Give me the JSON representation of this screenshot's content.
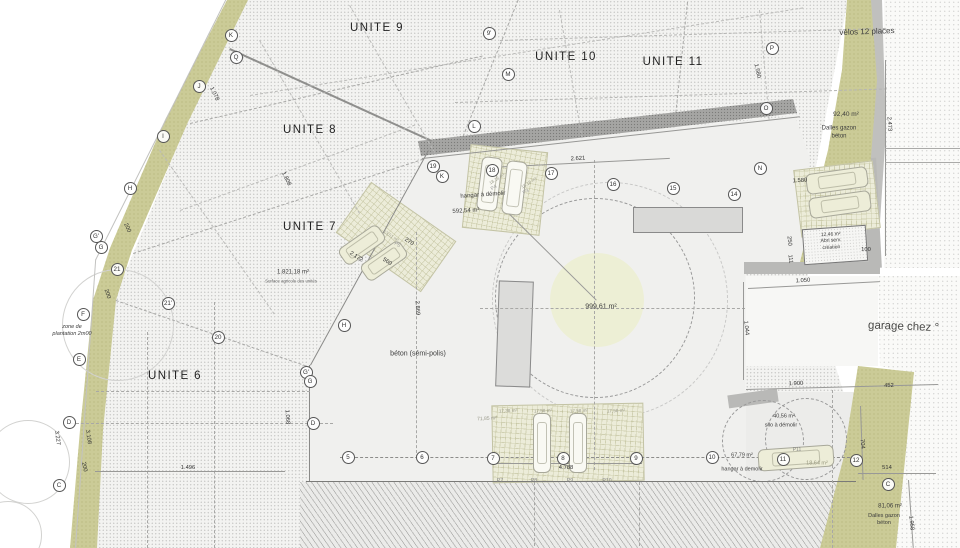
{
  "colors": {
    "paper": "#ffffff",
    "parcel_hatch": "#f3f3f1",
    "planting_strip": "#cbcb97",
    "parking_lot": "#ececd9",
    "boundary_band": "#a5a5a3",
    "building": "#dcdcda",
    "center_zone": "#edefd5",
    "text": "#3c3c3c"
  },
  "units": [
    {
      "label": "UNITE 9",
      "x": 377,
      "y": 28
    },
    {
      "label": "UNITE 10",
      "x": 566,
      "y": 57
    },
    {
      "label": "UNITE 11",
      "x": 673,
      "y": 62
    },
    {
      "label": "UNITE 8",
      "x": 310,
      "y": 130
    },
    {
      "label": "UNITE 7",
      "x": 310,
      "y": 227
    },
    {
      "label": "UNITE 6",
      "x": 175,
      "y": 376
    }
  ],
  "letter_markers": [
    {
      "label": "K",
      "x": 231,
      "y": 35
    },
    {
      "label": "Q",
      "x": 236,
      "y": 57
    },
    {
      "label": "J",
      "x": 199,
      "y": 86
    },
    {
      "label": "I",
      "x": 163,
      "y": 136
    },
    {
      "label": "H",
      "x": 130,
      "y": 188
    },
    {
      "label": "G'",
      "x": 96,
      "y": 236
    },
    {
      "label": "G",
      "x": 101,
      "y": 247
    },
    {
      "label": "F",
      "x": 83,
      "y": 314
    },
    {
      "label": "E",
      "x": 79,
      "y": 359
    },
    {
      "label": "D",
      "x": 69,
      "y": 422
    },
    {
      "label": "C",
      "x": 59,
      "y": 485
    },
    {
      "label": "H",
      "x": 344,
      "y": 325
    },
    {
      "label": "G'",
      "x": 306,
      "y": 372
    },
    {
      "label": "G",
      "x": 310,
      "y": 381
    },
    {
      "label": "D",
      "x": 313,
      "y": 423
    },
    {
      "label": "9'",
      "x": 489,
      "y": 33
    },
    {
      "label": "M",
      "x": 508,
      "y": 74
    },
    {
      "label": "L",
      "x": 474,
      "y": 126
    },
    {
      "label": "K",
      "x": 442,
      "y": 176
    },
    {
      "label": "P",
      "x": 772,
      "y": 48
    },
    {
      "label": "O",
      "x": 766,
      "y": 108
    },
    {
      "label": "N",
      "x": 760,
      "y": 168
    },
    {
      "label": "C",
      "x": 888,
      "y": 484
    }
  ],
  "number_markers": [
    {
      "label": "21",
      "x": 117,
      "y": 269
    },
    {
      "label": "21'",
      "x": 168,
      "y": 303
    },
    {
      "label": "20",
      "x": 218,
      "y": 337
    },
    {
      "label": "19",
      "x": 433,
      "y": 166
    },
    {
      "label": "18",
      "x": 492,
      "y": 170
    },
    {
      "label": "17",
      "x": 551,
      "y": 173
    },
    {
      "label": "16",
      "x": 613,
      "y": 184
    },
    {
      "label": "15",
      "x": 673,
      "y": 188
    },
    {
      "label": "14",
      "x": 734,
      "y": 194
    },
    {
      "label": "5",
      "x": 348,
      "y": 457
    },
    {
      "label": "6",
      "x": 422,
      "y": 457
    },
    {
      "label": "7",
      "x": 493,
      "y": 458
    },
    {
      "label": "8",
      "x": 563,
      "y": 458
    },
    {
      "label": "9",
      "x": 636,
      "y": 458
    },
    {
      "label": "10",
      "x": 712,
      "y": 457
    },
    {
      "label": "11",
      "x": 783,
      "y": 459
    },
    {
      "label": "12",
      "x": 856,
      "y": 460
    }
  ],
  "annotations": [
    {
      "text": "vélos 12 places",
      "x": 867,
      "y": 32,
      "fs": 8,
      "rot": -2
    },
    {
      "text": "92,40 m²",
      "x": 846,
      "y": 115,
      "fs": 6.5
    },
    {
      "text": "Dalles gazon\nbéton",
      "x": 839,
      "y": 133,
      "fs": 6
    },
    {
      "text": "hangar à démolir",
      "x": 483,
      "y": 196,
      "fs": 6,
      "rot": -4
    },
    {
      "text": "592,54 m²",
      "x": 466,
      "y": 212,
      "fs": 6,
      "rot": -3
    },
    {
      "text": "1.821,18 m²",
      "x": 293,
      "y": 273,
      "fs": 6
    },
    {
      "text": "Surface agricole des unités",
      "x": 291,
      "y": 281,
      "fs": 4.3,
      "color": "#666"
    },
    {
      "text": "zone de\nplantation 2m00",
      "x": 72,
      "y": 331,
      "fs": 5.5,
      "italic": true
    },
    {
      "text": "béton (sémi-polis)",
      "x": 418,
      "y": 355,
      "fs": 7
    },
    {
      "text": "999,61 m²",
      "x": 601,
      "y": 308,
      "fs": 7
    },
    {
      "text": "garage chez °",
      "x": 868,
      "y": 327,
      "fs": 11.5,
      "rot": 2,
      "color": "#4a4a48",
      "anchor": "left"
    },
    {
      "text": "12,46 m²\nAbri serv.\ncréation",
      "x": 831,
      "y": 241,
      "fs": 5,
      "rot": -3
    },
    {
      "text": "40,56 m²",
      "x": 784,
      "y": 417,
      "fs": 5.5
    },
    {
      "text": "silo à démolir",
      "x": 781,
      "y": 426,
      "fs": 5.5
    },
    {
      "text": "67,79 m²",
      "x": 742,
      "y": 456,
      "fs": 5.5
    },
    {
      "text": "hangar à demolir",
      "x": 742,
      "y": 470,
      "fs": 5.5
    },
    {
      "text": "18,64 m²",
      "x": 817,
      "y": 464,
      "fs": 5.5,
      "color": "#99997f"
    },
    {
      "text": "P11",
      "x": 797,
      "y": 450,
      "fs": 5,
      "color": "#888"
    },
    {
      "text": "81,06 m²",
      "x": 890,
      "y": 507,
      "fs": 6
    },
    {
      "text": "Dalles gazon\nbéton",
      "x": 884,
      "y": 520,
      "fs": 5.5
    },
    {
      "text": "71,85 m²",
      "x": 487,
      "y": 419,
      "fs": 5,
      "rot": -3,
      "color": "#99998a"
    },
    {
      "text": "17,38 m²",
      "x": 508,
      "y": 411,
      "fs": 4.6,
      "rot": -3,
      "color": "#99998a"
    },
    {
      "text": "17,58 m²",
      "x": 543,
      "y": 411,
      "fs": 4.6,
      "rot": -3,
      "color": "#99998a"
    },
    {
      "text": "17,58 m²",
      "x": 579,
      "y": 411,
      "fs": 4.6,
      "rot": -3,
      "color": "#99998a"
    },
    {
      "text": "17,58 m²",
      "x": 616,
      "y": 411,
      "fs": 4.6,
      "rot": -3,
      "color": "#99998a"
    },
    {
      "text": "P7",
      "x": 500,
      "y": 481,
      "fs": 5.2,
      "color": "#888"
    },
    {
      "text": "P8",
      "x": 534,
      "y": 481,
      "fs": 5.2,
      "color": "#888"
    },
    {
      "text": "P9",
      "x": 570,
      "y": 481,
      "fs": 5.2,
      "color": "#888"
    },
    {
      "text": "P10",
      "x": 607,
      "y": 481,
      "fs": 5.2,
      "color": "#888"
    },
    {
      "text": "18,18 m²",
      "x": 497,
      "y": 179,
      "fs": 4.4,
      "rot": -32,
      "color": "#a0a090"
    },
    {
      "text": "P4",
      "x": 494,
      "y": 188,
      "fs": 5,
      "rot": -32,
      "color": "#999"
    },
    {
      "text": "18,18 m²",
      "x": 529,
      "y": 183,
      "fs": 4.4,
      "rot": -32,
      "color": "#a0a090"
    },
    {
      "text": "P3",
      "x": 526,
      "y": 192,
      "fs": 5,
      "rot": -32,
      "color": "#999"
    },
    {
      "text": "13,51 m²",
      "x": 391,
      "y": 236,
      "fs": 4.4,
      "rot": 33,
      "color": "#a0a090"
    },
    {
      "text": "P5",
      "x": 397,
      "y": 245,
      "fs": 5,
      "rot": 33,
      "color": "#999"
    }
  ],
  "dimensions": [
    {
      "text": "2.621",
      "x": 578,
      "y": 159,
      "rot": -3
    },
    {
      "text": "1.580",
      "x": 757,
      "y": 71,
      "rot": 78
    },
    {
      "text": "1.580",
      "x": 800,
      "y": 181,
      "rot": -3
    },
    {
      "text": "2.473",
      "x": 889,
      "y": 124,
      "rot": 86
    },
    {
      "text": "1.078",
      "x": 214,
      "y": 94,
      "rot": 64
    },
    {
      "text": "1.808",
      "x": 286,
      "y": 179,
      "rot": 64
    },
    {
      "text": "200",
      "x": 127,
      "y": 228,
      "rot": 64
    },
    {
      "text": "200",
      "x": 107,
      "y": 294,
      "rot": 72
    },
    {
      "text": "200",
      "x": 84,
      "y": 467,
      "rot": 78
    },
    {
      "text": "3.227",
      "x": 57,
      "y": 438,
      "rot": 82
    },
    {
      "text": "3.108",
      "x": 88,
      "y": 437,
      "rot": 82
    },
    {
      "text": "1.496",
      "x": 188,
      "y": 468,
      "rot": 0
    },
    {
      "text": "2.172",
      "x": 356,
      "y": 257,
      "rot": 33
    },
    {
      "text": "560",
      "x": 387,
      "y": 262,
      "rot": 33
    },
    {
      "text": "270",
      "x": 409,
      "y": 242,
      "rot": 33
    },
    {
      "text": "2.869",
      "x": 417,
      "y": 308,
      "rot": 87
    },
    {
      "text": "1.068",
      "x": 287,
      "y": 417,
      "rot": 87
    },
    {
      "text": "4.788",
      "x": 566,
      "y": 468,
      "rot": 0
    },
    {
      "text": "1.900",
      "x": 796,
      "y": 384,
      "rot": -2
    },
    {
      "text": "452",
      "x": 889,
      "y": 386,
      "rot": -2
    },
    {
      "text": "1.050",
      "x": 803,
      "y": 281,
      "rot": -3
    },
    {
      "text": "1.044",
      "x": 746,
      "y": 328,
      "rot": 84
    },
    {
      "text": "704",
      "x": 862,
      "y": 444,
      "rot": 84
    },
    {
      "text": "514",
      "x": 887,
      "y": 468,
      "rot": 0
    },
    {
      "text": "1.958",
      "x": 911,
      "y": 523,
      "rot": 84
    },
    {
      "text": "250",
      "x": 789,
      "y": 241,
      "rot": 84
    },
    {
      "text": "111",
      "x": 790,
      "y": 259,
      "rot": 84
    },
    {
      "text": "100",
      "x": 866,
      "y": 250,
      "rot": 0
    }
  ],
  "linework": [
    {
      "x": 230,
      "y": 48,
      "len": 222,
      "rot": 24.5,
      "style": "solid",
      "color": "#8f8f8d",
      "w": 2
    },
    {
      "x": 190,
      "y": 123,
      "len": 300,
      "rot": -13,
      "style": "dashed",
      "color": "#a8a8a6",
      "w": 1
    },
    {
      "x": 133,
      "y": 253,
      "len": 305,
      "rot": -18,
      "style": "dashed",
      "color": "#a8a8a6",
      "w": 1
    },
    {
      "x": 116,
      "y": 300,
      "len": 206,
      "rot": 19,
      "style": "dashed",
      "color": "#a8a8a6",
      "w": 1
    },
    {
      "x": 310,
      "y": 365,
      "len": 245,
      "rot": -61.2,
      "style": "solid",
      "color": "#8a8a88",
      "w": 1
    },
    {
      "x": 310,
      "y": 365,
      "len": 117,
      "rot": 90,
      "style": "solid",
      "color": "#8a8a88",
      "w": 1
    },
    {
      "x": 306,
      "y": 481,
      "len": 550,
      "rot": 0,
      "style": "solid",
      "color": "#7a7a78",
      "w": 1
    },
    {
      "x": 422,
      "y": 158,
      "len": 380,
      "rot": -6.3,
      "style": "solid",
      "color": "#979795",
      "w": 1
    },
    {
      "x": 457,
      "y": 150,
      "len": 162,
      "rot": -68,
      "style": "dashed",
      "color": "#a8a8a6",
      "w": 1
    },
    {
      "x": 688,
      "y": 2,
      "len": 126,
      "rot": 96,
      "style": "dashed",
      "color": "#a8a8a6",
      "w": 1
    },
    {
      "x": 500,
      "y": 40,
      "len": 386,
      "rot": -1.8,
      "style": "dashed",
      "color": "#b5b5b3",
      "w": 1
    },
    {
      "x": 455,
      "y": 102,
      "len": 432,
      "rot": -1.8,
      "style": "dashed",
      "color": "#b5b5b3",
      "w": 1
    },
    {
      "x": 250,
      "y": 95,
      "len": 560,
      "rot": -9,
      "style": "dashed",
      "color": "#bbbbb9",
      "w": 1
    },
    {
      "x": 180,
      "y": 210,
      "len": 250,
      "rot": -20,
      "style": "dashed",
      "color": "#bbbbb9",
      "w": 1
    },
    {
      "x": 350,
      "y": 5,
      "len": 170,
      "rot": 60,
      "style": "dashed",
      "color": "#bbbbb9",
      "w": 1
    },
    {
      "x": 260,
      "y": 40,
      "len": 200,
      "rot": 60,
      "style": "dashed",
      "color": "#bbbbb9",
      "w": 1
    },
    {
      "x": 160,
      "y": 150,
      "len": 200,
      "rot": 55,
      "style": "dashed",
      "color": "#bbbbb9",
      "w": 1
    },
    {
      "x": 560,
      "y": 10,
      "len": 130,
      "rot": 80,
      "style": "dashed",
      "color": "#bbbbb9",
      "w": 1
    },
    {
      "x": 760,
      "y": 10,
      "len": 110,
      "rot": 85,
      "style": "dashed",
      "color": "#bbbbb9",
      "w": 1
    },
    {
      "x": 148,
      "y": 332,
      "len": 216,
      "rot": 90,
      "style": "dashed",
      "color": "#a8a8a6",
      "w": 1
    },
    {
      "x": 215,
      "y": 302,
      "len": 246,
      "rot": 90,
      "style": "dashed",
      "color": "#a8a8a6",
      "w": 1
    },
    {
      "x": 96,
      "y": 391,
      "len": 214,
      "rot": 0,
      "style": "dashed",
      "color": "#a8a8a6",
      "w": 1
    },
    {
      "x": 71,
      "y": 423,
      "len": 262,
      "rot": 0,
      "style": "dashed",
      "color": "#a8a8a6",
      "w": 1
    },
    {
      "x": 340,
      "y": 457,
      "len": 520,
      "rot": 0,
      "style": "dashed",
      "color": "#8c8c8a",
      "w": 1
    },
    {
      "x": 417,
      "y": 232,
      "len": 226,
      "rot": 90,
      "style": "dashed",
      "color": "#a8a8a6",
      "w": 1
    },
    {
      "x": 595,
      "y": 160,
      "len": 310,
      "rot": 90,
      "style": "dashed",
      "color": "#a8a8a6",
      "w": 1
    },
    {
      "x": 480,
      "y": 308,
      "len": 265,
      "rot": 0,
      "style": "dashed",
      "color": "#a8a8a6",
      "w": 1
    },
    {
      "x": 490,
      "y": 167,
      "len": 180,
      "rot": -2.9,
      "style": "solid",
      "color": "#999997",
      "w": 1
    },
    {
      "x": 497,
      "y": 463,
      "len": 145,
      "rot": 0,
      "style": "solid",
      "color": "#999997",
      "w": 1
    },
    {
      "x": 95,
      "y": 471,
      "len": 190,
      "rot": 0,
      "style": "solid",
      "color": "#999997",
      "w": 1
    },
    {
      "x": 746,
      "y": 389,
      "len": 192,
      "rot": -1.5,
      "style": "solid",
      "color": "#999997",
      "w": 1
    },
    {
      "x": 748,
      "y": 288,
      "len": 132,
      "rot": -3,
      "style": "solid",
      "color": "#999997",
      "w": 1
    },
    {
      "x": 886,
      "y": 60,
      "len": 196,
      "rot": 90,
      "style": "solid",
      "color": "#999997",
      "w": 1
    },
    {
      "x": 861,
      "y": 406,
      "len": 74,
      "rot": 88,
      "style": "solid",
      "color": "#999997",
      "w": 1
    },
    {
      "x": 858,
      "y": 473,
      "len": 78,
      "rot": 0,
      "style": "solid",
      "color": "#999997",
      "w": 1
    },
    {
      "x": 909,
      "y": 480,
      "len": 68,
      "rot": 86,
      "style": "solid",
      "color": "#999997",
      "w": 1
    },
    {
      "x": 744,
      "y": 282,
      "len": 98,
      "rot": 90,
      "style": "solid",
      "color": "#999997",
      "w": 1
    },
    {
      "x": 95,
      "y": 260,
      "len": 291,
      "rot": -63.4,
      "style": "solid",
      "color": "#c2c2c0",
      "w": 1
    },
    {
      "x": 75,
      "y": 548,
      "len": 289,
      "rot": -86,
      "style": "solid",
      "color": "#c2c2c0",
      "w": 1
    },
    {
      "x": 510,
      "y": 214,
      "len": 122,
      "rot": 44.7,
      "style": "solid",
      "color": "#9a9a98",
      "w": 1
    },
    {
      "x": 833,
      "y": 390,
      "len": 158,
      "rot": 90,
      "style": "dashed",
      "color": "#a8a8a6",
      "w": 1
    },
    {
      "x": 535,
      "y": 482,
      "len": 64,
      "rot": 90,
      "style": "dashed",
      "color": "#a8a8a6",
      "w": 1
    },
    {
      "x": 640,
      "y": 482,
      "len": 64,
      "rot": 90,
      "style": "dashed",
      "color": "#a8a8a6",
      "w": 1
    },
    {
      "x": 885,
      "y": 148,
      "len": 75,
      "rot": 0,
      "style": "solid",
      "color": "#aaaaa8",
      "w": 1
    },
    {
      "x": 885,
      "y": 162,
      "len": 75,
      "rot": 0,
      "style": "solid",
      "color": "#aaaaa8",
      "w": 1
    }
  ],
  "cars": [
    {
      "x": 479,
      "y": 157,
      "w": 21,
      "h": 54,
      "rot": 7,
      "light": true
    },
    {
      "x": 504,
      "y": 161,
      "w": 21,
      "h": 54,
      "rot": 7,
      "light": true
    },
    {
      "x": 352,
      "y": 221,
      "w": 20,
      "h": 48,
      "rot": 55,
      "light": false
    },
    {
      "x": 374,
      "y": 237,
      "w": 20,
      "h": 48,
      "rot": 55,
      "light": false
    },
    {
      "x": 806,
      "y": 170,
      "w": 62,
      "h": 21,
      "rot": -8,
      "light": false
    },
    {
      "x": 809,
      "y": 194,
      "w": 62,
      "h": 21,
      "rot": -8,
      "light": false
    },
    {
      "x": 533,
      "y": 413,
      "w": 18,
      "h": 60,
      "rot": 0,
      "light": true
    },
    {
      "x": 569,
      "y": 413,
      "w": 18,
      "h": 60,
      "rot": 0,
      "light": true
    },
    {
      "x": 758,
      "y": 447,
      "w": 76,
      "h": 22,
      "rot": -4,
      "light": false
    }
  ]
}
